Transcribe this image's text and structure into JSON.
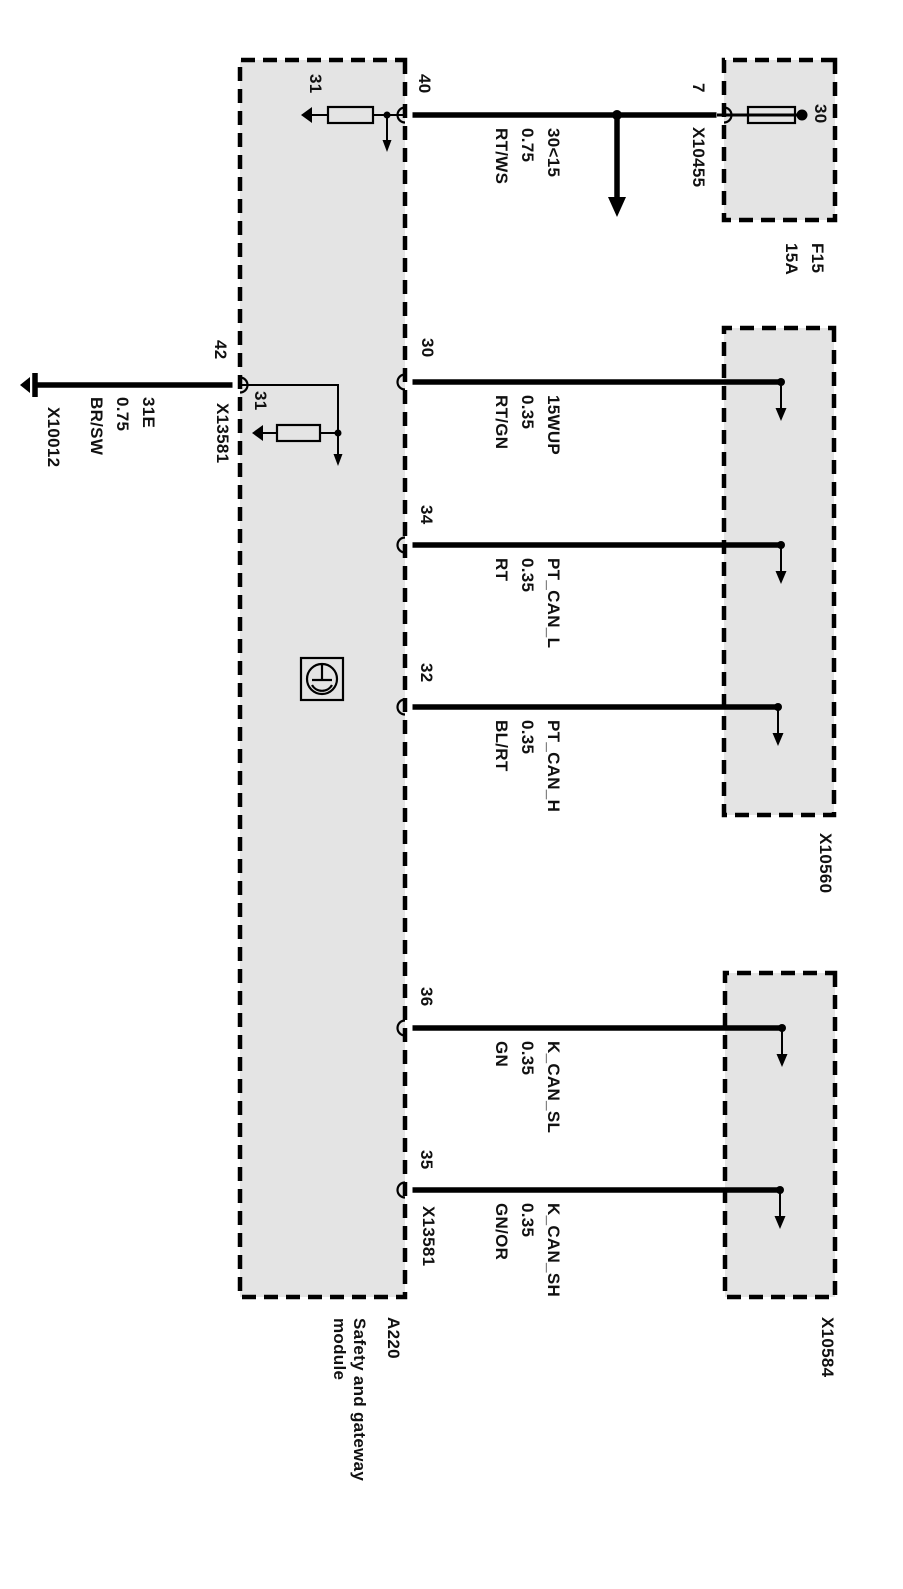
{
  "module": {
    "id": "A220",
    "name_line1": "Safety and gateway",
    "name_line2": "module"
  },
  "fuse": {
    "id": "F15",
    "rating": "15A",
    "terminal": "30",
    "pin": "7"
  },
  "connectors": {
    "x10455": "X10455",
    "x13581": "X13581",
    "x10560": "X10560",
    "x10584": "X10584",
    "x10012": "X10012"
  },
  "wires": [
    {
      "pin": "40",
      "signal": "30<15",
      "cross_section": "0.75",
      "color": "RT/WS"
    },
    {
      "pin": "30",
      "signal": "15WUP",
      "cross_section": "0.35",
      "color": "RT/GN"
    },
    {
      "pin": "34",
      "signal": "PT_CAN_L",
      "cross_section": "0.35",
      "color": "RT"
    },
    {
      "pin": "32",
      "signal": "PT_CAN_H",
      "cross_section": "0.35",
      "color": "BL/RT"
    },
    {
      "pin": "36",
      "signal": "K_CAN_SL",
      "cross_section": "0.35",
      "color": "GN"
    },
    {
      "pin": "35",
      "signal": "K_CAN_SH",
      "cross_section": "0.35",
      "color": "GN/OR"
    },
    {
      "pin": "42",
      "signal": "31E",
      "cross_section": "0.75",
      "color": "BR/SW"
    }
  ],
  "internal": {
    "ground_terminal_a": "31",
    "ground_terminal_b": "31"
  },
  "colors": {
    "background": "#ffffff",
    "box-fill": "#e4e4e4",
    "line": "#000000",
    "text": "#111111"
  }
}
